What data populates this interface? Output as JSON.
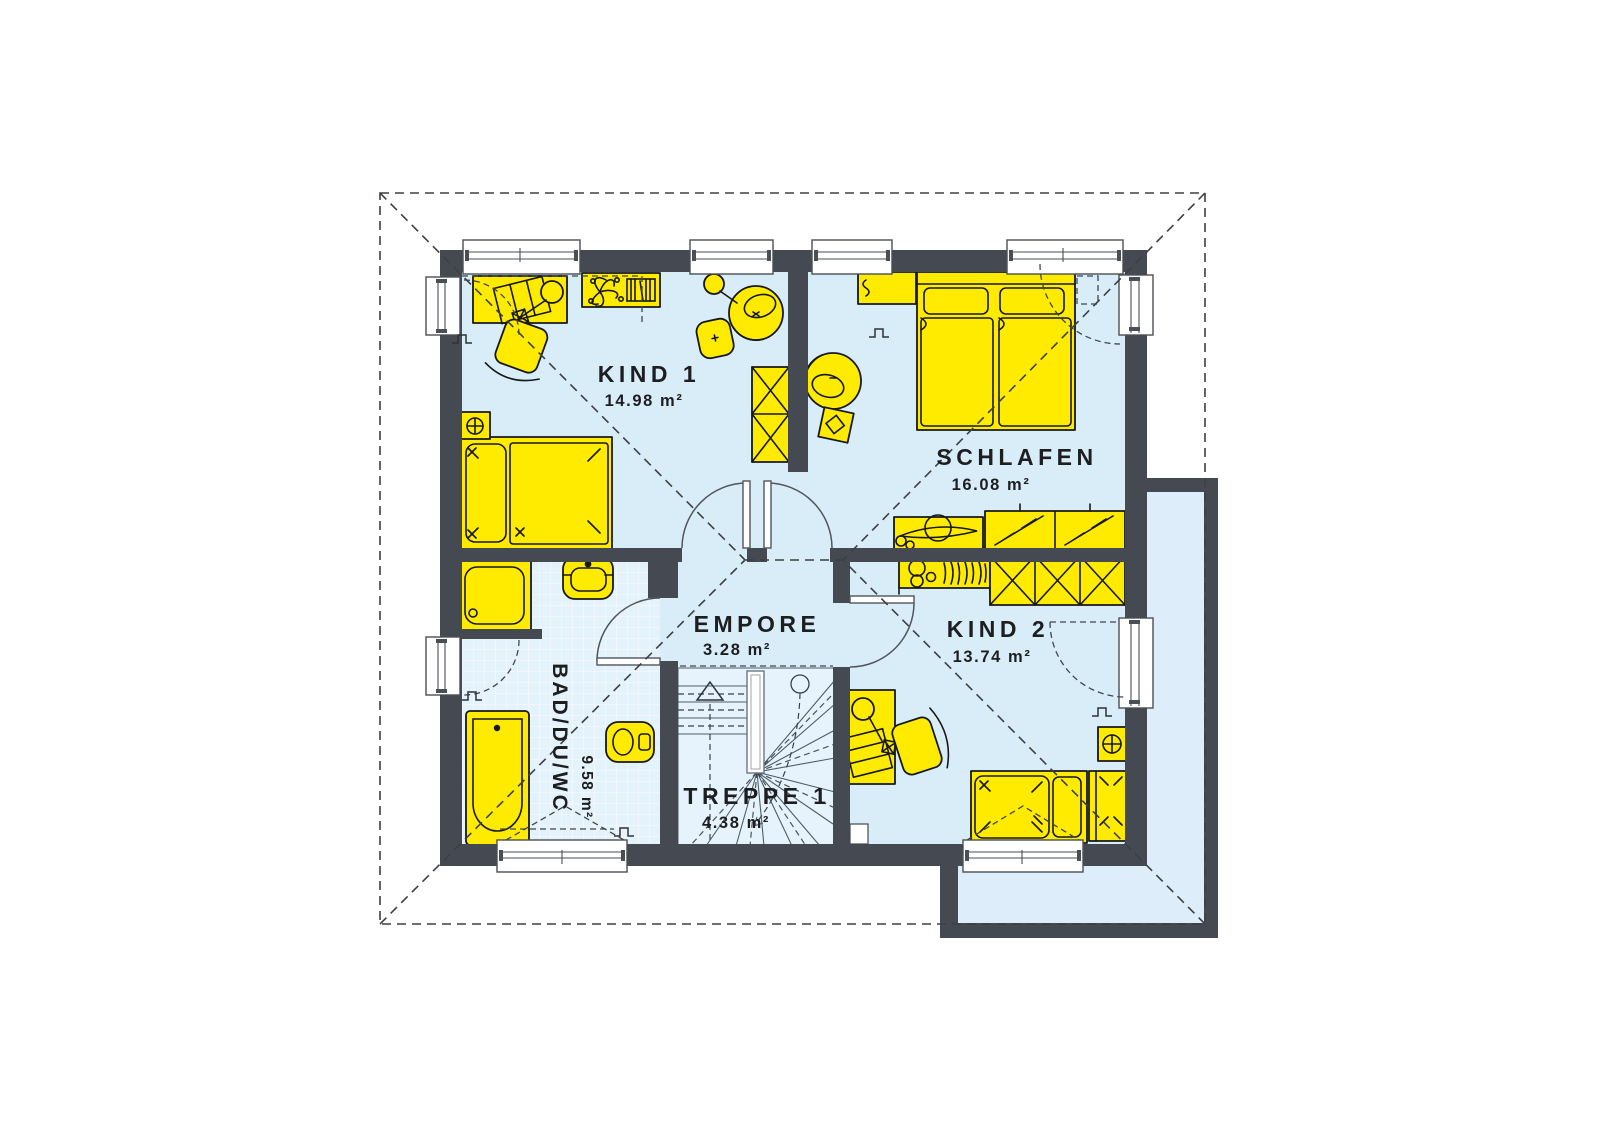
{
  "plan": {
    "kind": "floor-plan",
    "rooms": [
      {
        "id": "kind1",
        "name": "KIND 1",
        "area": "14.98 m²"
      },
      {
        "id": "schlafen",
        "name": "SCHLAFEN",
        "area": "16.08 m²"
      },
      {
        "id": "kind2",
        "name": "KIND 2",
        "area": "13.74 m²"
      },
      {
        "id": "empore",
        "name": "EMPORE",
        "area": "3.28 m²"
      },
      {
        "id": "bad",
        "name": "BAD/DU/WC",
        "area": "9.58 m²"
      },
      {
        "id": "treppe1",
        "name": "TREPPE 1",
        "area": "4.38 m²"
      }
    ],
    "colors": {
      "wall": "#454a52",
      "floor": "#d9edf9",
      "floor_bath": "#e4f2fb",
      "furniture": "#ffeb00",
      "outline": "#17181a",
      "roof_dash": "#3c4043",
      "background": "#ffffff"
    }
  }
}
